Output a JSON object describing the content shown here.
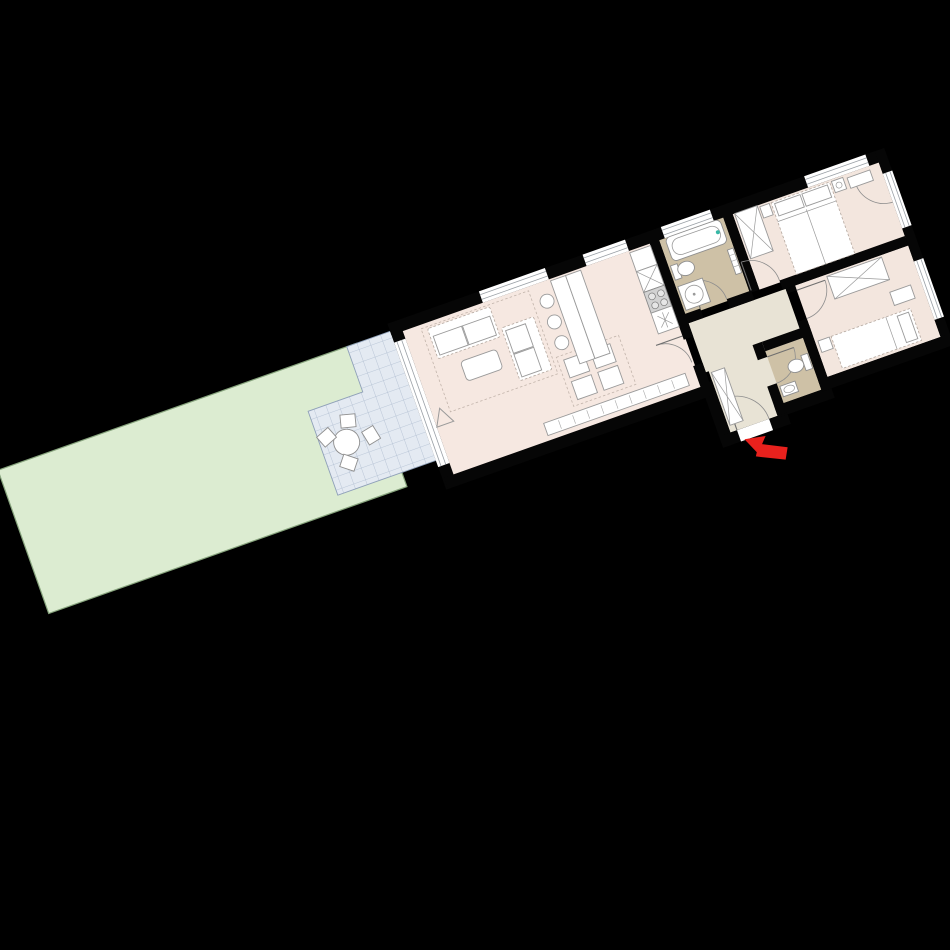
{
  "app": {
    "title": "Apartment floor plan with garden",
    "description": "Rotated 2D architectural floor plan of a long narrow apartment on a black background",
    "plan_rotation_deg": -19.5
  },
  "colors": {
    "background": "#000000",
    "wall": "#060606",
    "living_floor": "#f6e8e1",
    "bedroom_floor": "#f3e6de",
    "bathroom_floor": "#cec1a6",
    "hall_floor": "#e8e3d5",
    "terrace_tile": "#e4eaf2",
    "terrace_grid": "#aebcd0",
    "garden_fill": "#dcecd1",
    "garden_stroke": "#86a37c",
    "furniture_fill": "#ffffff",
    "furniture_stroke": "#9a9a9a",
    "stove_fill": "#d2d2d2",
    "entrance_arrow": "#e8211d",
    "faucet_accent": "#35b8a6"
  },
  "rooms": [
    {
      "id": "garden",
      "label": "Garden",
      "features": [
        "lawn"
      ]
    },
    {
      "id": "terrace",
      "label": "Terrace",
      "features": [
        "tiled floor",
        "round table",
        "4 chairs"
      ]
    },
    {
      "id": "living_room",
      "label": "Living / Dining",
      "features": [
        "sofa",
        "second sofa",
        "coffee table",
        "rug",
        "sideboard",
        "dining table",
        "4 dining chairs",
        "north-marker"
      ]
    },
    {
      "id": "kitchen",
      "label": "Kitchen",
      "features": [
        "island counter",
        "3 bar stools",
        "fridge unit",
        "sink unit",
        "stove 4 burners",
        "vent unit"
      ]
    },
    {
      "id": "bathroom",
      "label": "Bathroom",
      "features": [
        "bathtub",
        "toilet",
        "shower basin",
        "towel radiator"
      ]
    },
    {
      "id": "hallway",
      "label": "Hallway",
      "features": [
        "closet",
        "entrance door"
      ]
    },
    {
      "id": "wc",
      "label": "WC",
      "features": [
        "toilet",
        "washbasin"
      ]
    },
    {
      "id": "master_bedroom",
      "label": "Bedroom 1",
      "features": [
        "double bed",
        "wardrobe",
        "nightstands",
        "dresser",
        "french door"
      ]
    },
    {
      "id": "bedroom_2",
      "label": "Bedroom 2",
      "features": [
        "single bed",
        "wardrobe",
        "nightstand",
        "bench"
      ]
    },
    {
      "id": "entrance",
      "label": "Entrance",
      "features": [
        "red direction arrow",
        "door swing"
      ]
    }
  ],
  "icons": {
    "entrance_arrow": "red arrow pointing to entrance door",
    "north_marker": "small triangle orientation marker"
  }
}
